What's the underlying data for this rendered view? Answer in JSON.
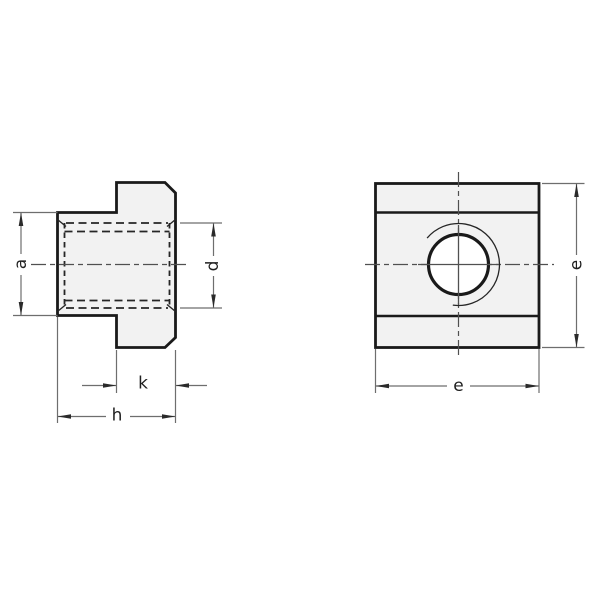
{
  "drawing": {
    "labels": {
      "a": "a",
      "d": "d",
      "k": "k",
      "h": "h",
      "e_width": "e",
      "e_height": "e"
    },
    "colors": {
      "background": "#ffffff",
      "part_fill": "#f2f2f2",
      "outline": "#1a1a1a",
      "thin_line": "#6e6e6e",
      "hidden_line": "#262626",
      "centerline": "#505050",
      "arrow": "#2a2a2a",
      "label_text": "#1f1f1f"
    }
  }
}
